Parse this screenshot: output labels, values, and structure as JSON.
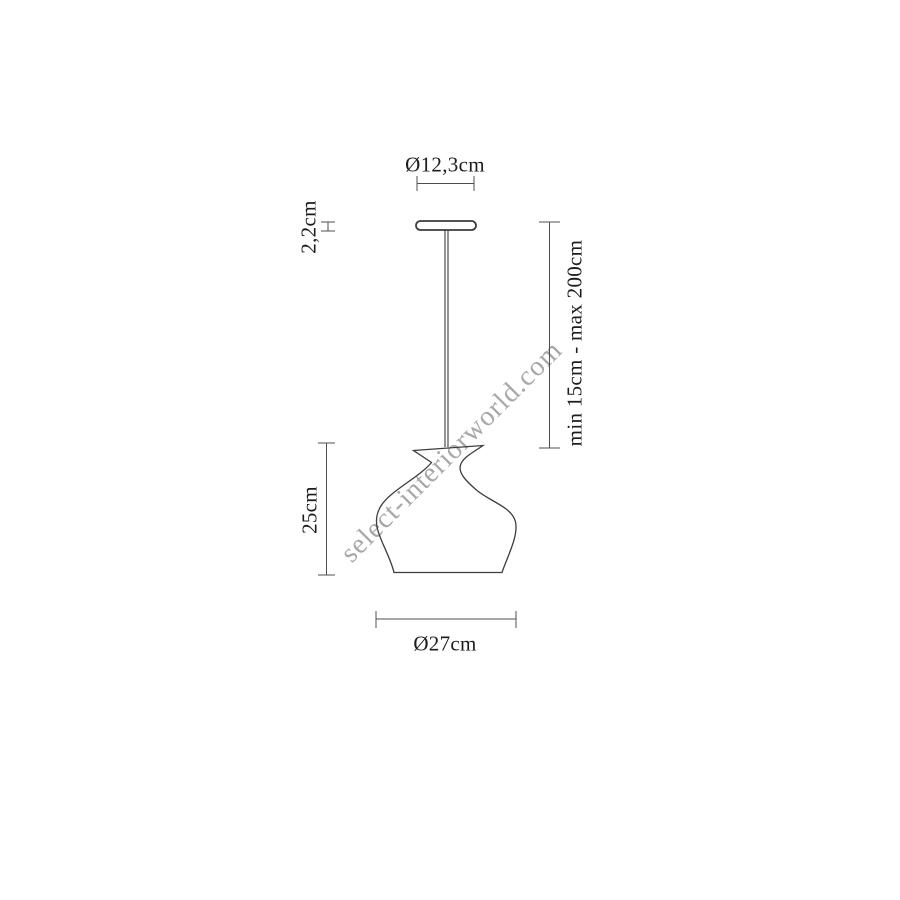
{
  "drawing": {
    "title": "pendant-lamp-dimension-diagram",
    "labels": {
      "canopy_diameter": "Ø12,3cm",
      "canopy_height": "2,2cm",
      "suspension_range": "min 15cm - max 200cm",
      "shade_height": "25cm",
      "shade_diameter": "Ø27cm"
    },
    "watermark": "select-interiorworld.com",
    "colors": {
      "background": "#ffffff",
      "lamp_outline": "#3d3d3d",
      "dimension_line": "#4f4f4f",
      "label_text": "#1c1c1c",
      "watermark": "#a8a8a8"
    }
  }
}
